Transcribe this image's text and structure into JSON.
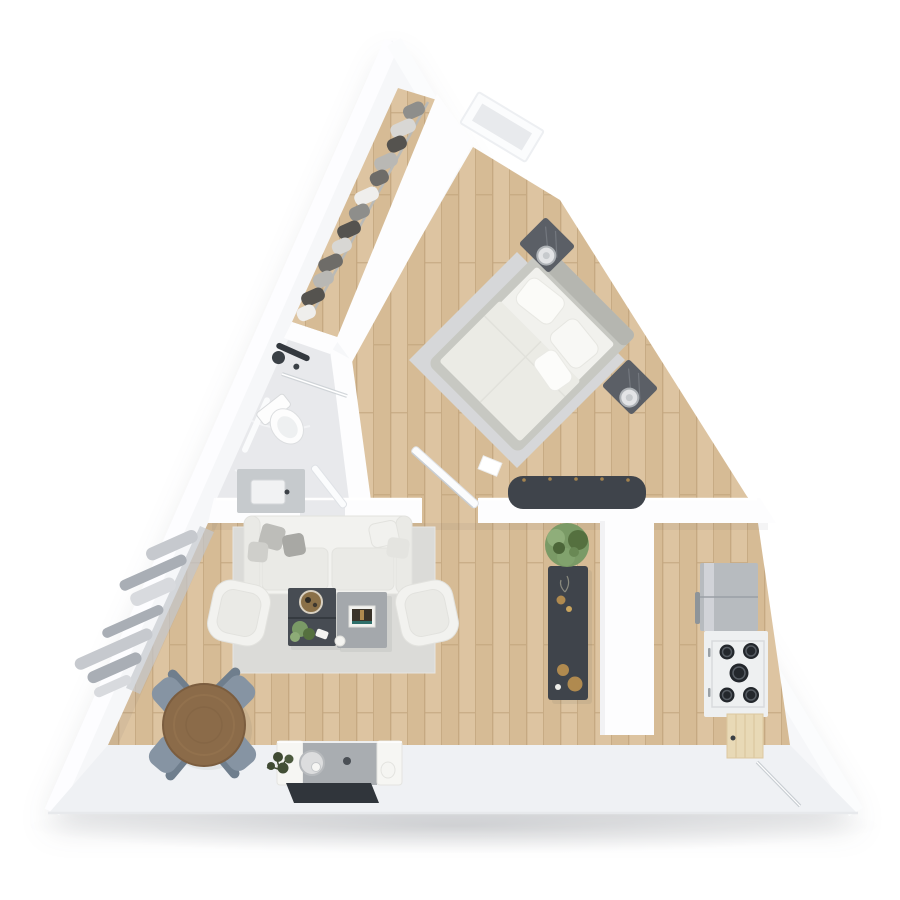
{
  "title": "Triangular A-frame apartment - 3D top-down floor plan render",
  "colors": {
    "bg": "#ffffff",
    "wall": "#f6f7f9",
    "wall_bright": "#fdfdfe",
    "wall_band": "#eff1f4",
    "wall_edge": "#e4e7eb",
    "wood": "#d6bb95",
    "wood_alt": "#ddc4a1",
    "wood_seam": "#c2a57d",
    "tile": "#e8e9ec",
    "tile_vein": "#f4f5f7",
    "rug_living": "#dbdbd8",
    "rug_bed": "#d6d7d9",
    "sofa": "#f2f2ef",
    "sofa_line": "#e2e2de",
    "cushion": "#eaeae6",
    "pillow_gray": "#b9b9b5",
    "dark_table": "#474c53",
    "gray_table": "#a4a8ac",
    "dark_furniture": "#3f444b",
    "steel": "#b7bbbf",
    "steel_hi": "#d7dade",
    "marble": "#eef0f1",
    "burner": "#23272c",
    "table_wood": "#8b6b49",
    "chair_blue": "#8694a3",
    "chair_blue_dark": "#6f7e8d",
    "plant_green": "#7a9a66",
    "plant_dark": "#55703f",
    "plant_deep": "#3f4a33",
    "tv_dark": "#30353b",
    "console_gray": "#a9adb1",
    "gold": "#b08a4f",
    "white_furniture": "#f6f6f3",
    "curtain_a": "#c6c9ce",
    "curtain_b": "#a9aeb5",
    "curtain_c": "#d8dade",
    "glass": "#e8eaed",
    "bed_frame": "#c7c8c2",
    "mattress": "#f1f1ed",
    "duvet": "#ebebe5",
    "nightstand": "#5b5f66",
    "door_wood": "#e8d9b6"
  },
  "rooms": {
    "closet": {
      "label": "walk-in closet",
      "hanging_clothes": 13
    },
    "bathroom": {
      "label": "bathroom",
      "fixtures": [
        "shower",
        "glass screen",
        "toilet",
        "vanity with sink"
      ]
    },
    "bedroom": {
      "label": "bedroom",
      "furniture": [
        "double bed",
        "two pillows",
        "nightstand with lamp (left)",
        "nightstand with lamp (right)",
        "area rug",
        "storage bench",
        "apex window",
        "door"
      ]
    },
    "living_room": {
      "label": "living room",
      "furniture": [
        "sofa with cushions",
        "armchair (left)",
        "armchair (right)",
        "dark coffee table",
        "gray side table",
        "area rug",
        "curtains",
        "round dining table",
        "dining chairs",
        "media console",
        "round speaker",
        "wall-mounted TV",
        "plants"
      ],
      "dining_chairs": 4
    },
    "kitchen": {
      "label": "kitchen",
      "furniture": [
        "dark sideboard with decor",
        "potted plant",
        "partition wall",
        "refrigerator",
        "cooktop",
        "base cabinets",
        "entry door"
      ],
      "cooktop_burners": 5
    }
  }
}
